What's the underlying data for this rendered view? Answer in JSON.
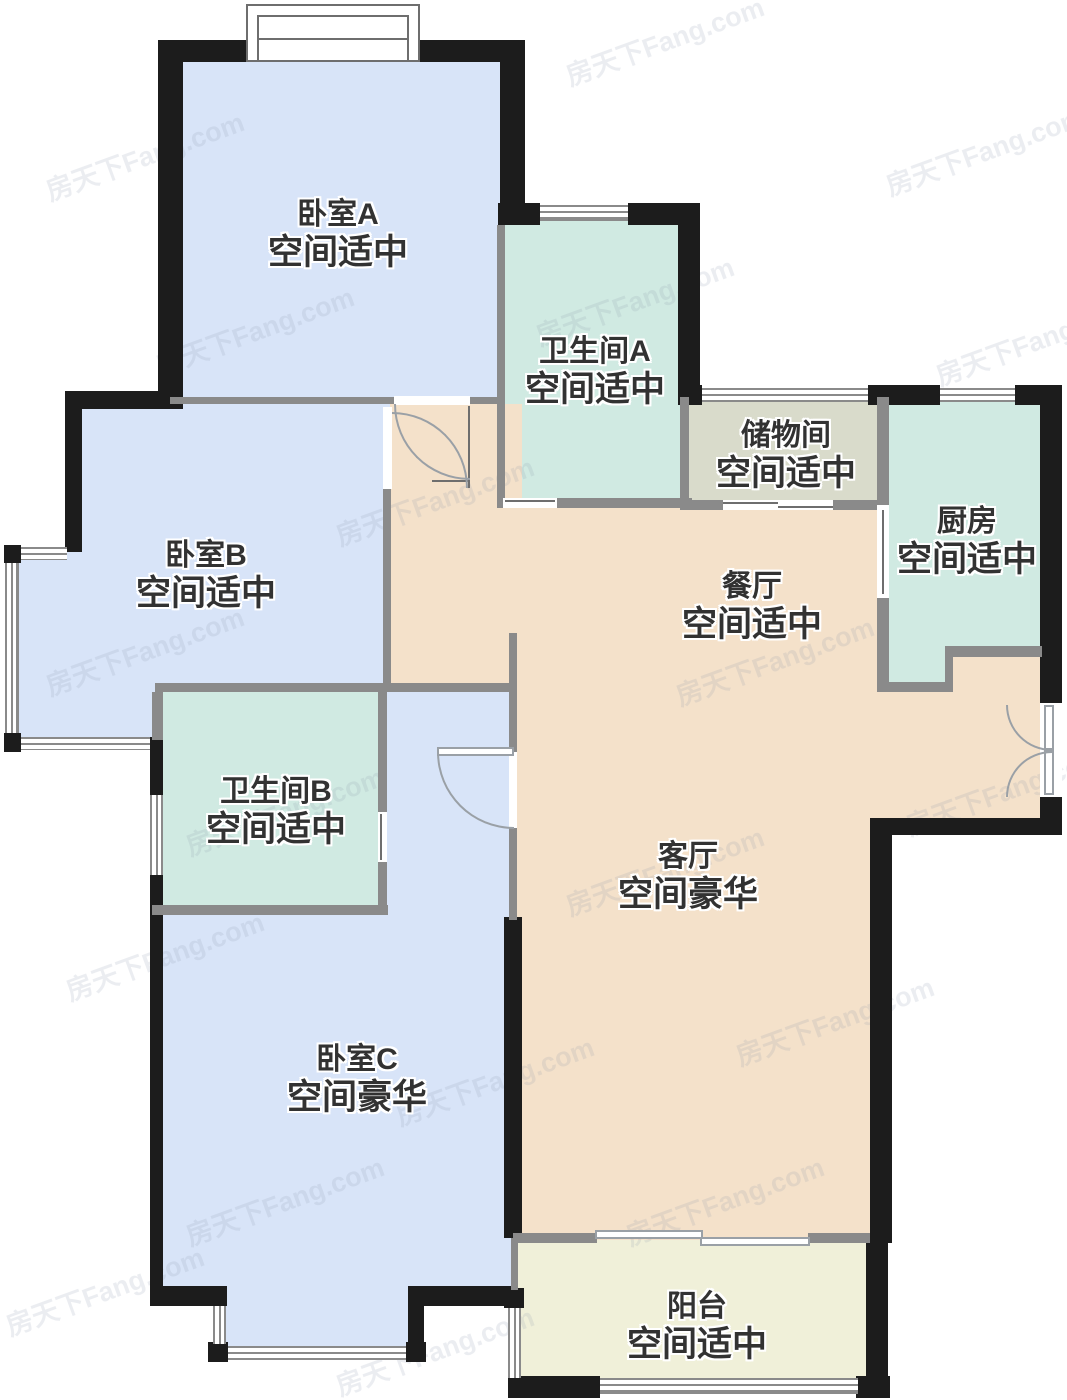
{
  "plan_title": "floor-plan",
  "watermark": {
    "text": "房天下Fang.com",
    "color": "#8b97ab"
  },
  "colors": {
    "wall_black": "#1c1c1c",
    "wall_gray": "#8a8a8a",
    "door_arc": "#9aa0a6",
    "room_blue": "#d8e4f8",
    "room_teal": "#d0eae2",
    "room_storage": "#d9dbcb",
    "room_peach": "#f4e1ca",
    "room_balcony": "#f0f0d9",
    "label": "#323232",
    "watermark": "#8b97ab",
    "background": "#ffffff"
  },
  "rooms": [
    {
      "id": "bedroom-a",
      "name": "卧室A",
      "status": "空间适中"
    },
    {
      "id": "bathroom-a",
      "name": "卫生间A",
      "status": "空间适中"
    },
    {
      "id": "storage",
      "name": "储物间",
      "status": "空间适中"
    },
    {
      "id": "kitchen",
      "name": "厨房",
      "status": "空间适中"
    },
    {
      "id": "bedroom-b",
      "name": "卧室B",
      "status": "空间适中"
    },
    {
      "id": "dining",
      "name": "餐厅",
      "status": "空间适中"
    },
    {
      "id": "bathroom-b",
      "name": "卫生间B",
      "status": "空间适中"
    },
    {
      "id": "living",
      "name": "客厅",
      "status": "空间豪华"
    },
    {
      "id": "bedroom-c",
      "name": "卧室C",
      "status": "空间豪华"
    },
    {
      "id": "balcony",
      "name": "阳台",
      "status": "空间适中"
    }
  ]
}
